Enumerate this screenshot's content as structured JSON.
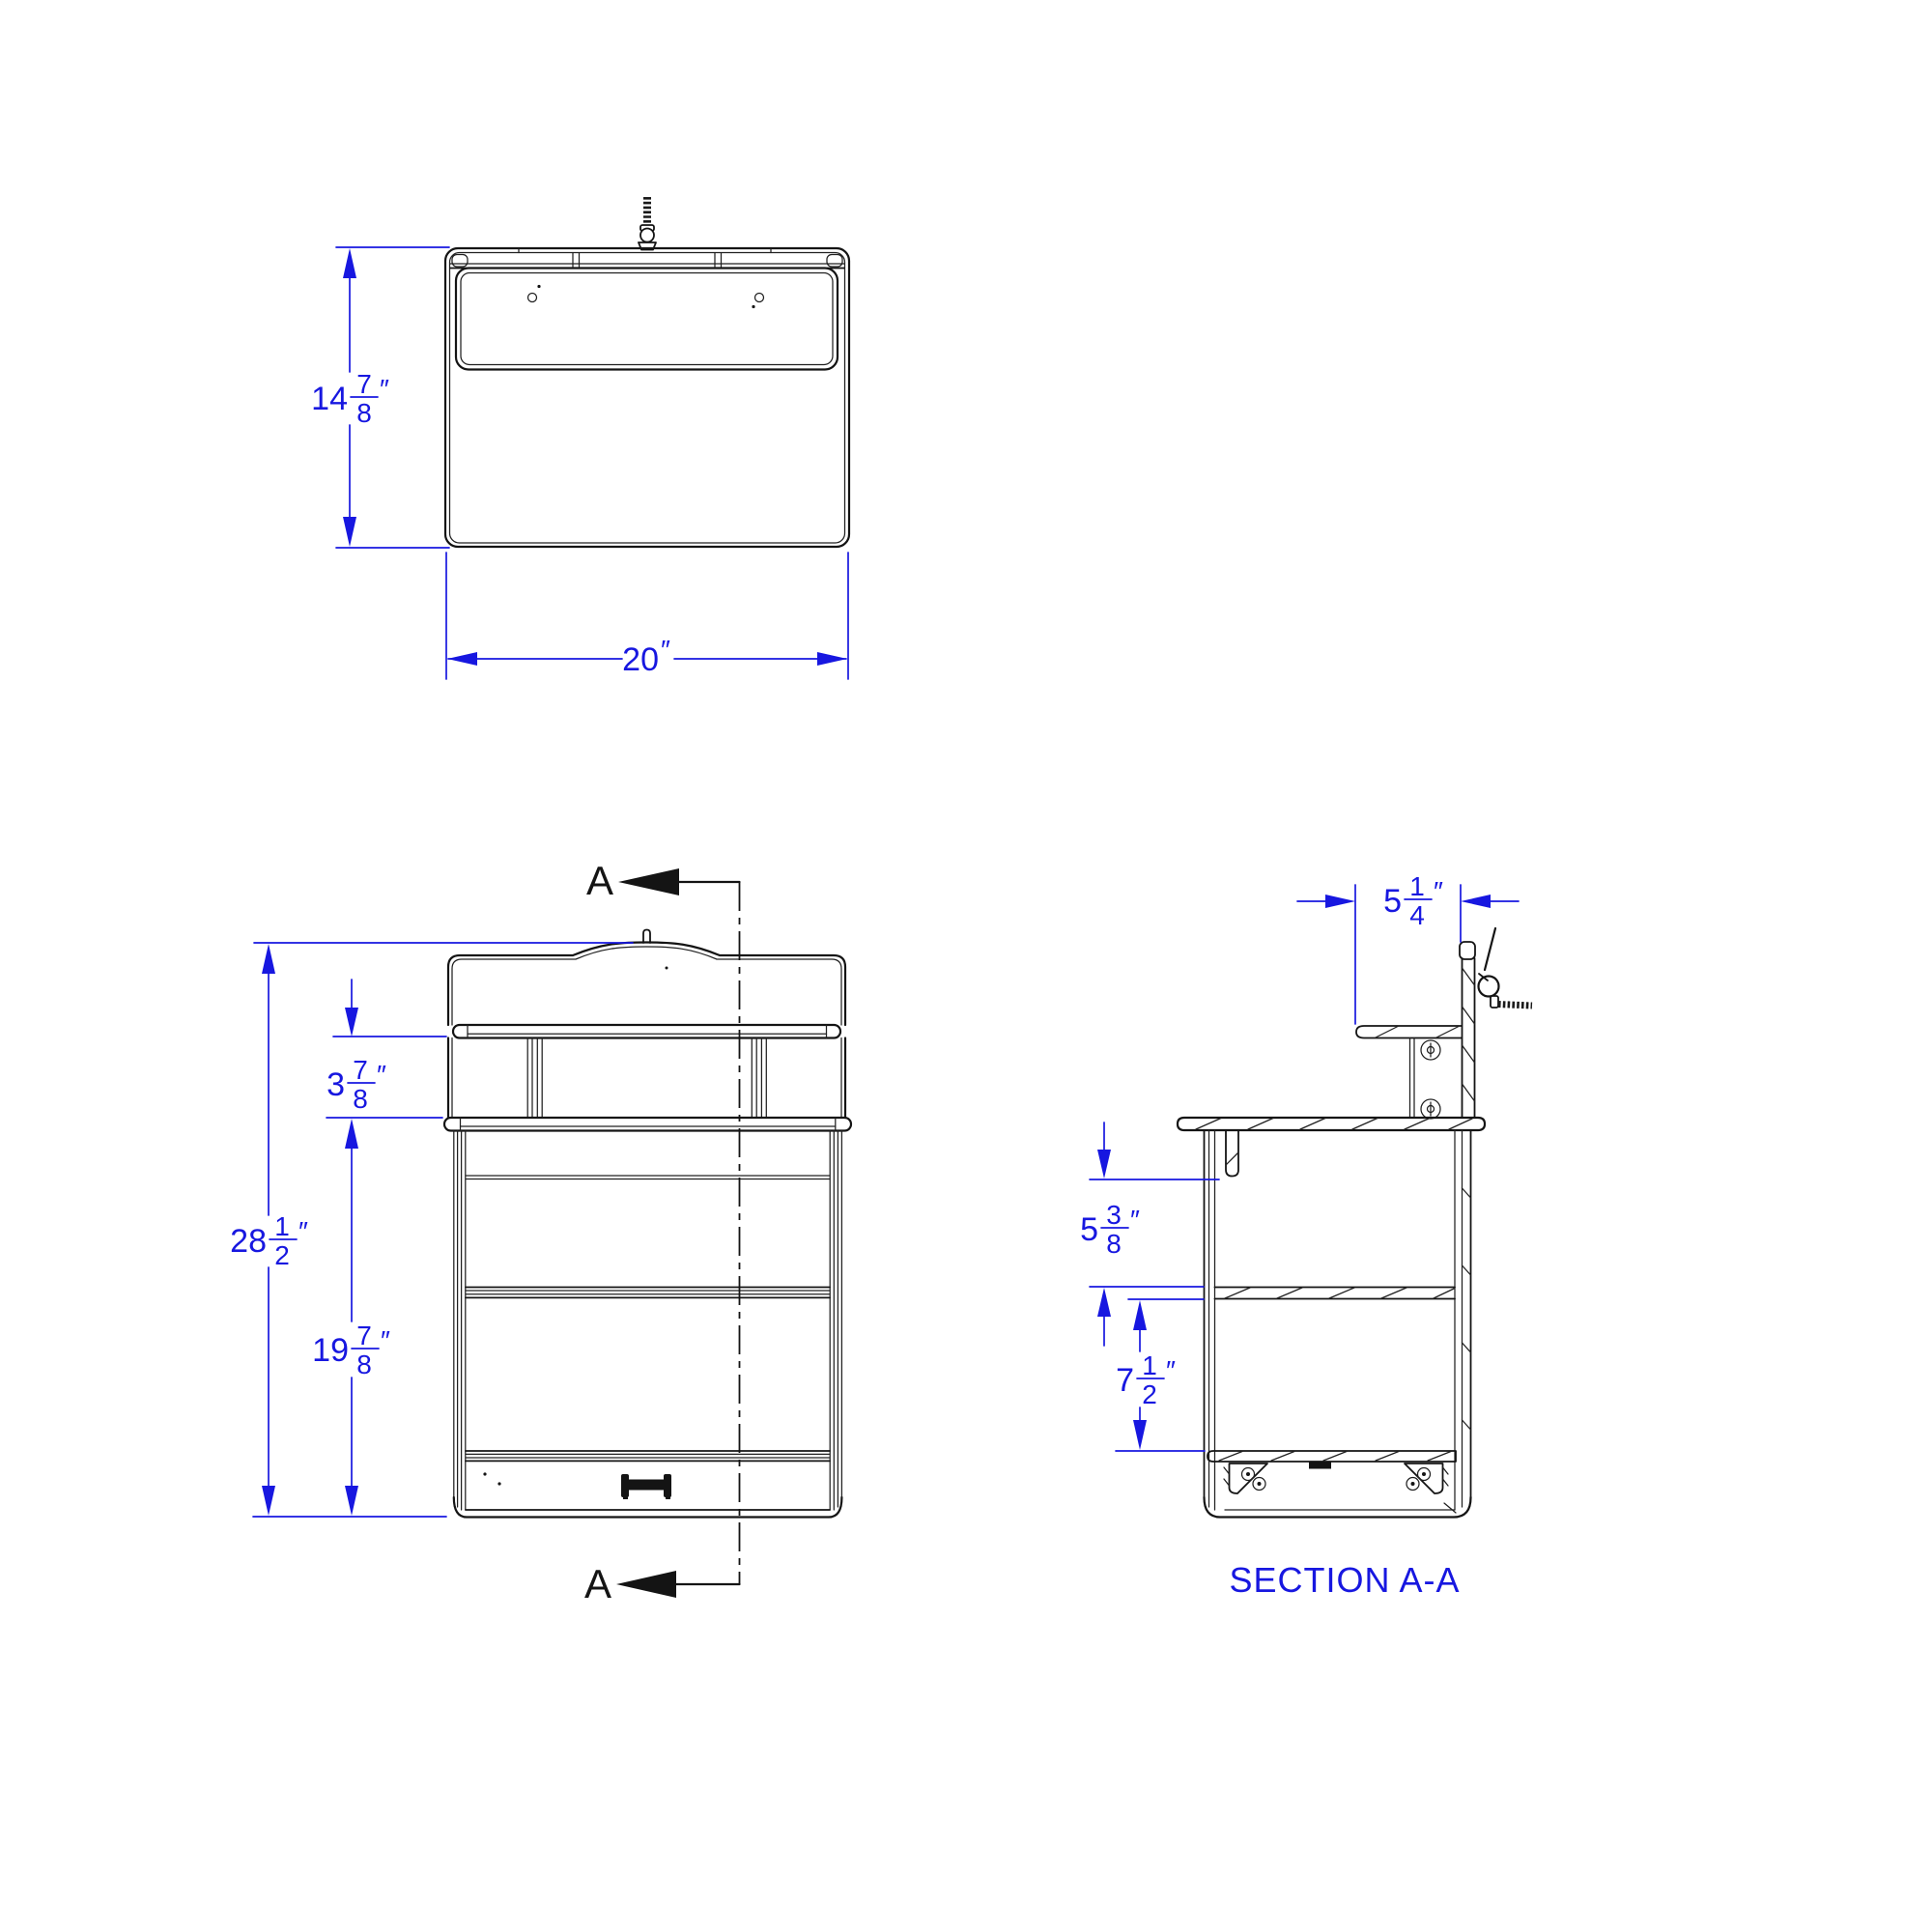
{
  "drawing": {
    "dimension_color": "#1717e0",
    "line_color": "#141414",
    "section_marker": {
      "label": "A"
    },
    "section_title": "SECTION A-A",
    "dimensions": {
      "top_height": {
        "whole": "14",
        "numerator": "7",
        "denominator": "8",
        "unit": "″"
      },
      "top_width": {
        "whole": "20",
        "unit": "″"
      },
      "riser_height": {
        "whole": "3",
        "numerator": "7",
        "denominator": "8",
        "unit": "″"
      },
      "overall_height": {
        "whole": "28",
        "numerator": "1",
        "denominator": "2",
        "unit": "″"
      },
      "worktop_height": {
        "whole": "19",
        "numerator": "7",
        "denominator": "8",
        "unit": "″"
      },
      "shelf_depth": {
        "whole": "5",
        "numerator": "1",
        "denominator": "4",
        "unit": "″"
      },
      "hook_clearance": {
        "whole": "5",
        "numerator": "3",
        "denominator": "8",
        "unit": "″"
      },
      "shelf_spacing": {
        "whole": "7",
        "numerator": "1",
        "denominator": "2",
        "unit": "″"
      }
    }
  }
}
